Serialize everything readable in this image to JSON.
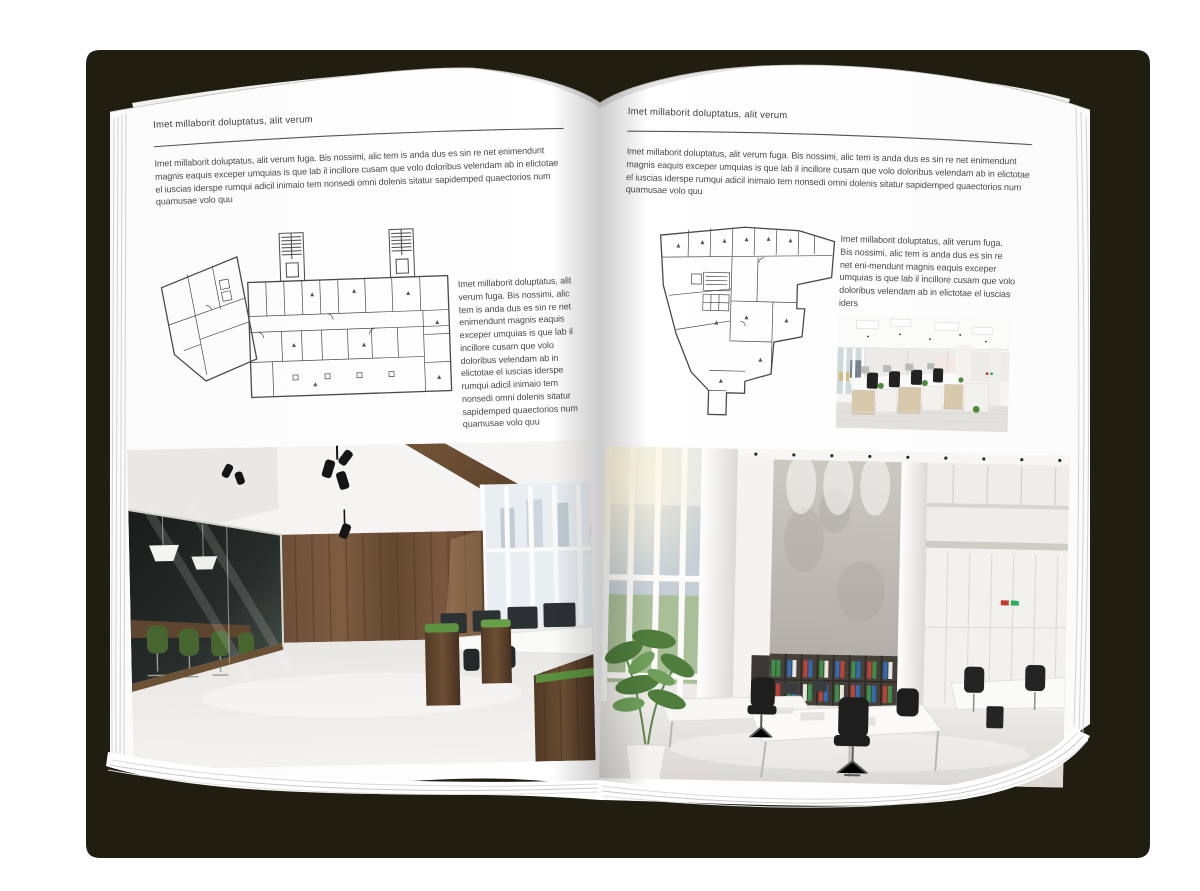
{
  "book": {
    "left_page": {
      "header": "Imet millaborit doluptatus, alit verum",
      "intro": "Imet millaborit doluptatus, alit verum fuga. Bis nossimi, alic tem is anda dus es sin re net enimendunt magnis eaquis exceper umquias is que lab il incillore cusam que volo doloribus velendam ab in elictotae el iuscias iderspe rumqui adicil inimaio tem nonsedi omni dolenis sitatur sapidemped quaectorios num quamusae volo quu",
      "plan_caption": "Imet millaborit doluptatus, alit verum fuga. Bis nossimi, alic tem is anda dus es sin re net enimendunt magnis eaquis exceper umquias is que lab il incillore cusam que volo doloribus velendam ab in elictotae el iuscias iderspe rumqui adicil inimaio tem nonsedi omni dolenis sitatur sapidemped quaectorios num quamusae volo quu",
      "floorplan_alt": "Architectural floor plan drawing of an L-shaped office building",
      "photo_alt": "Office interior photo: glass meeting room with green chairs, wooden wall and workstations"
    },
    "right_page": {
      "header": "Imet millaborit doluptatus, alit verum",
      "intro": "Imet millaborit doluptatus, alit verum fuga. Bis nossimi, alic tem is anda dus es sin re net enimendunt magnis eaquis exceper umquias is que lab il incillore cusam que volo doloribus velendam ab in elictotae el iuscias iderspe rumqui adicil inimaio tem nonsedi omni dolenis sitatur sapidemped quaectorios num quamusae volo quu",
      "plan_caption": "Imet millaborit doluptatus, alit verum fuga. Bis nossimi, alic tem is anda dus es sin re net eni-mendunt magnis eaquis exceper umquias is que lab il incillore cusam que volo doloribus velendam ab in elictotae el iuscias iders",
      "floorplan_alt": "Architectural floor plan drawing of an irregular tower footprint",
      "small_photo_alt": "Office interior photo: rows of light wood workstations with black chairs",
      "photo_alt": "Office interior photo: white open space with tall windows, concrete wall and binder shelves"
    },
    "colors": {
      "cover": "#201e11",
      "page": "#ffffff",
      "text": "#4a4a4a",
      "rule": "#555555"
    }
  }
}
